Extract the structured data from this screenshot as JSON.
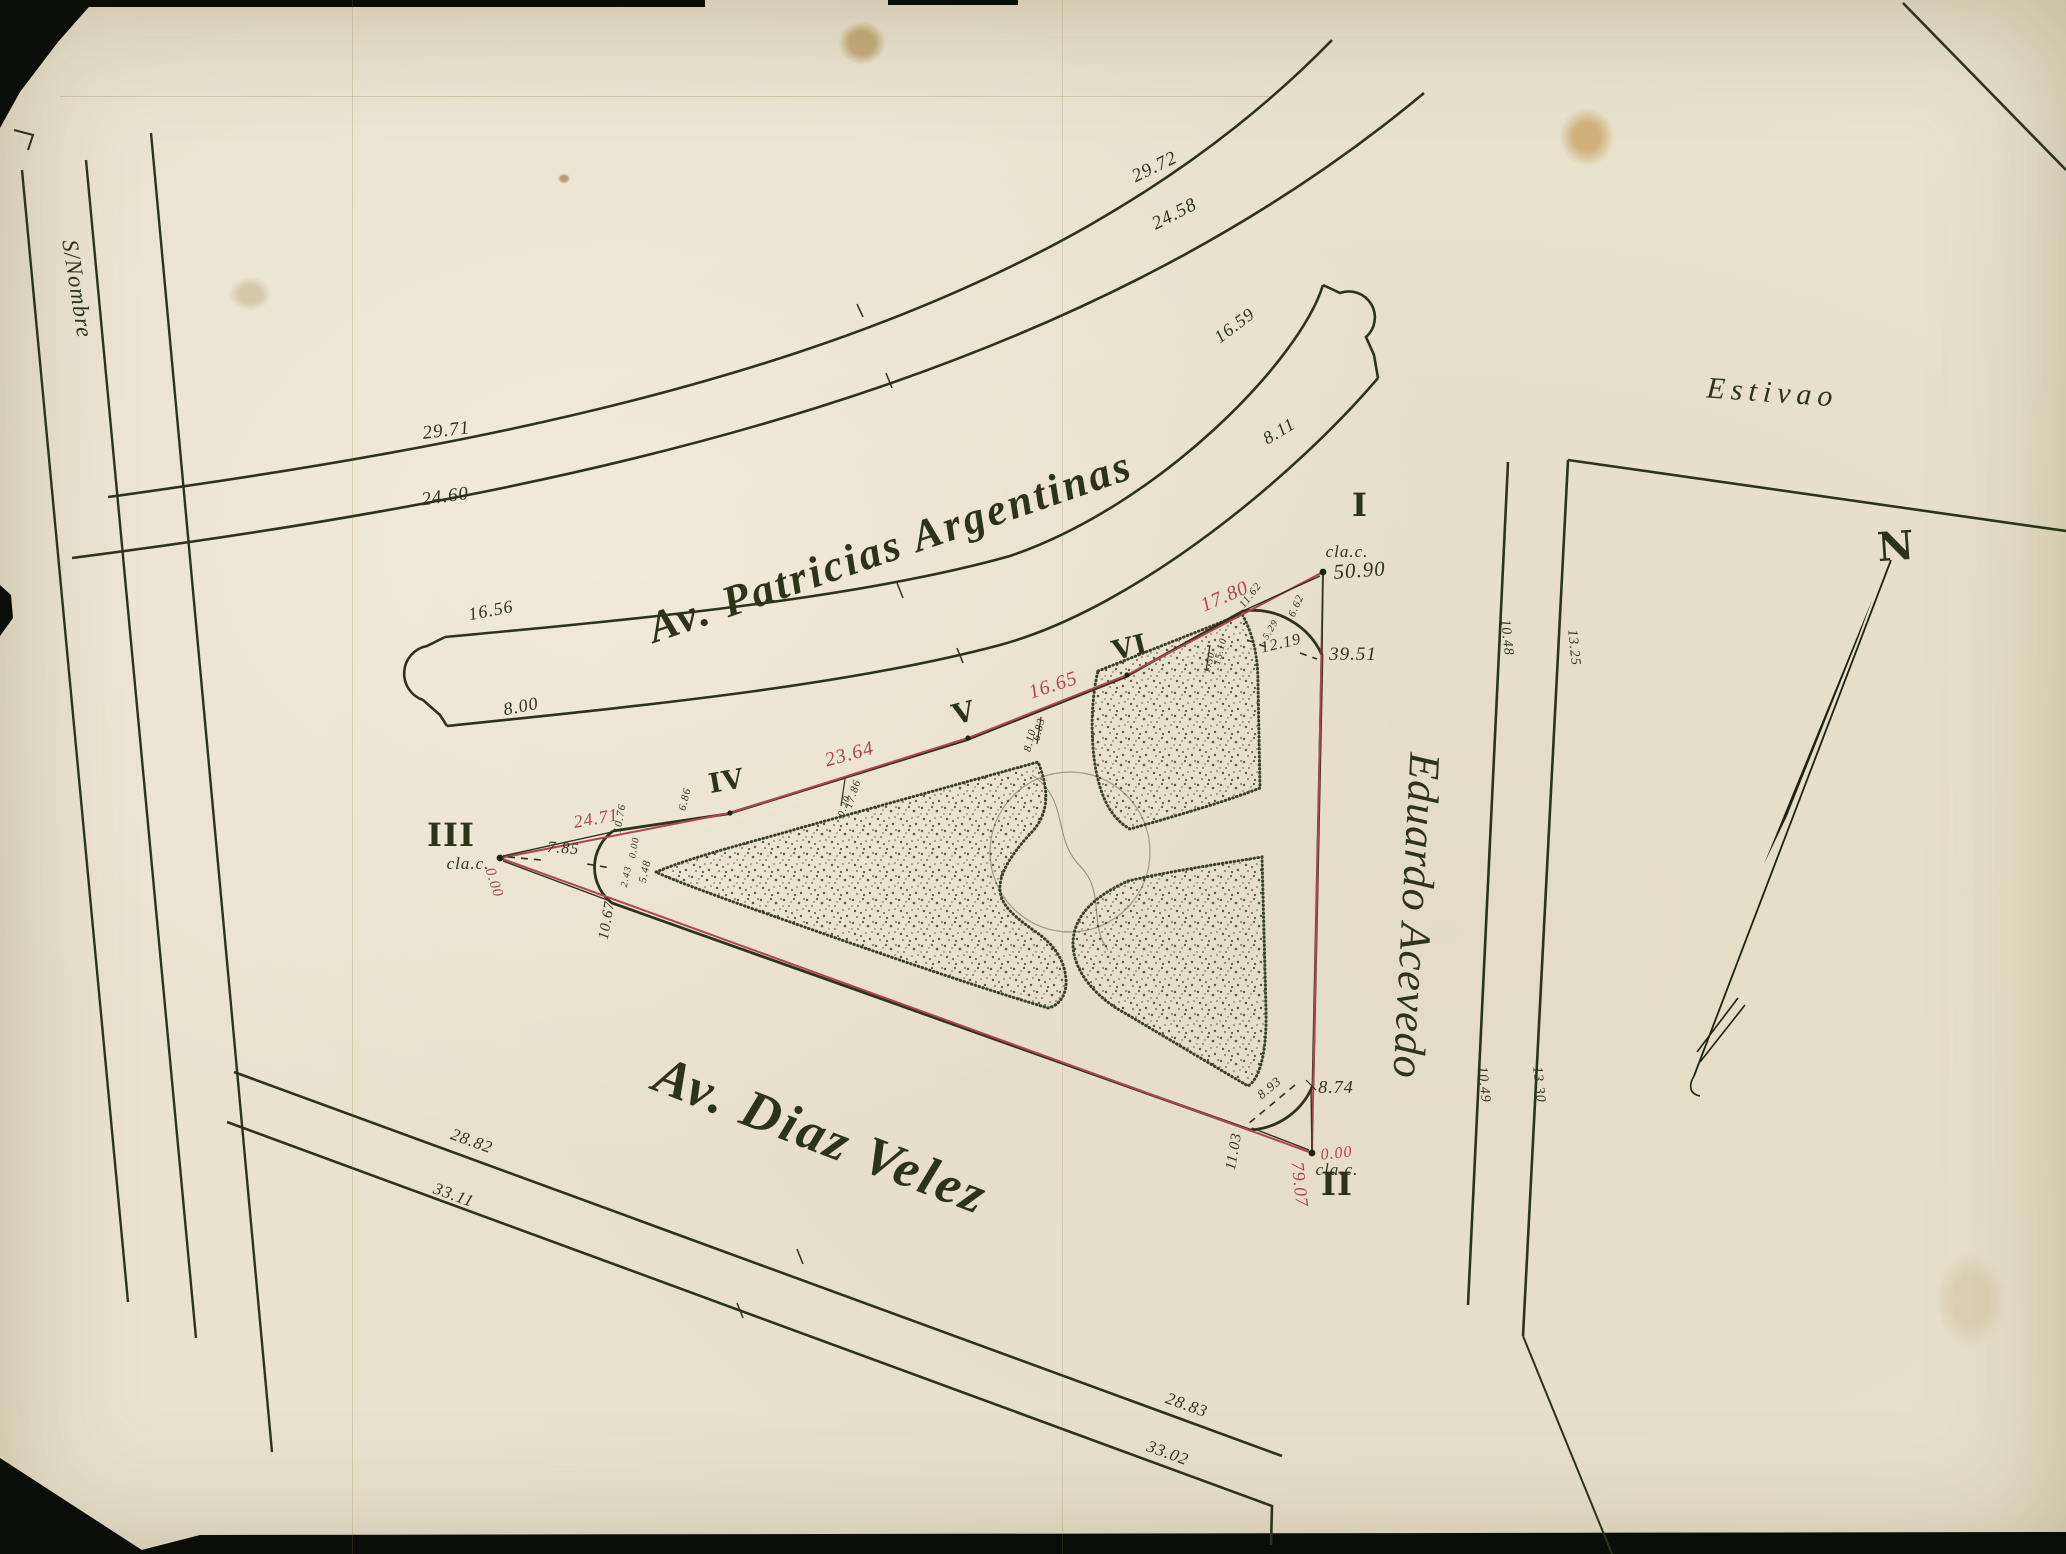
{
  "colors": {
    "paper": "#e9e2cd",
    "ink": "#2c3418",
    "red_traverse": "#b0454d"
  },
  "compass": {
    "north": "N"
  },
  "map": {
    "streets": {
      "sin_nombre": {
        "name": "S/Nombre"
      },
      "estivao": {
        "name": "Estivao"
      },
      "patricias": {
        "name": "Av. Patricias Argentinas",
        "outer1_left": "29.71",
        "outer1_right": "29.72",
        "outer2_left": "24.60",
        "outer2_right": "24.58",
        "walk_top_left": "16.56",
        "walk_top_right": "16.59",
        "walk_bot_left": "8.00",
        "walk_bot_right": "8.11"
      },
      "diaz_velez": {
        "name": "Av. Diaz Velez",
        "north_left": "28.82",
        "north_right": "28.83",
        "south_left": "33.11",
        "south_right": "33.02"
      },
      "acevedo": {
        "name": "Eduardo Acevedo",
        "curb_upper": "10.48",
        "curb_lower": "10.49",
        "block_upper": "13.25",
        "block_lower": "13.30"
      }
    },
    "survey": {
      "p1": {
        "numeral": "I",
        "marker": "cla.c.",
        "level": "50.90",
        "tangent": "39.51",
        "chord": "12.19",
        "o1": "11.62",
        "o2": "6.62",
        "o3": "5.29",
        "red_seg": "17.80"
      },
      "p2": {
        "numeral": "II",
        "marker": "cla.c.",
        "level_red": "0.00",
        "tangent": "8.74",
        "chord": "8.93",
        "o1": "11.03",
        "red_side": "79.07"
      },
      "p3": {
        "numeral": "III",
        "marker": "cla.c.",
        "level_red": "0.00",
        "axis": "7.85",
        "o1": "10.76",
        "o2": "0.00",
        "o3": "5.48",
        "o4": "2.43",
        "tangent": "10.67",
        "red_seg": "24.71"
      },
      "p4": {
        "numeral": "IV",
        "o1": "6.86",
        "o2": "17.86",
        "o3": "0.20",
        "red_seg": "23.64"
      },
      "p5": {
        "numeral": "V",
        "o1": "6.83",
        "o2": "8.10",
        "red_seg": "16.65"
      },
      "p6": {
        "numeral": "VI",
        "o1": "15.10",
        "o2": "1.50"
      }
    }
  }
}
